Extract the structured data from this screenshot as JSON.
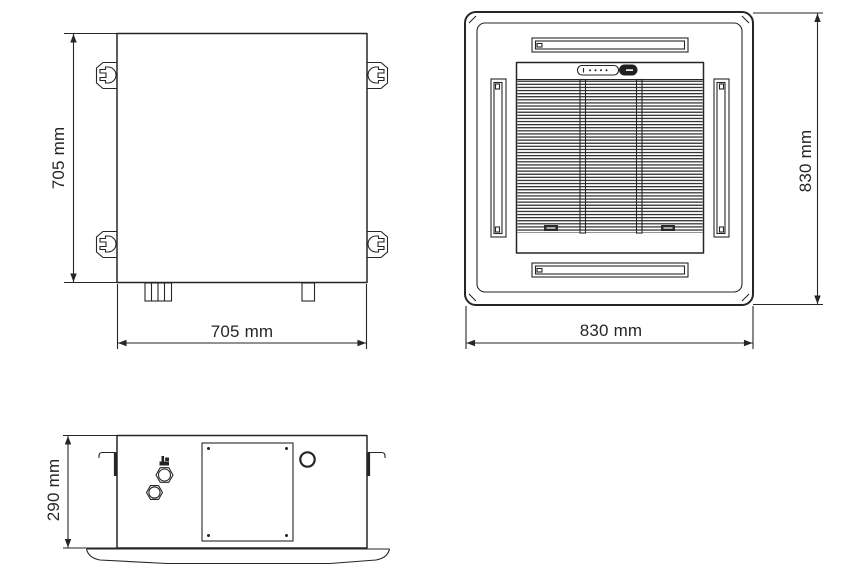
{
  "page": {
    "background": "#ffffff",
    "line_color": "#262626"
  },
  "views": {
    "top_view": {
      "width_label": "705 mm",
      "height_label": "705 mm"
    },
    "panel_view": {
      "width_label": "830 mm",
      "height_label": "830 mm"
    },
    "side_view": {
      "height_label": "290 mm"
    }
  }
}
